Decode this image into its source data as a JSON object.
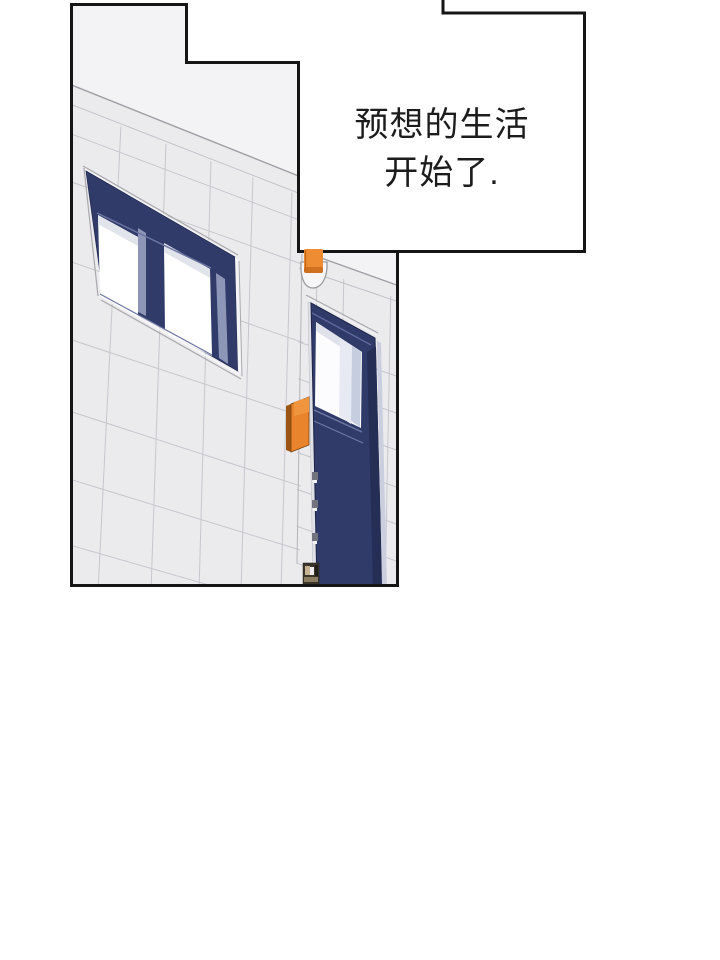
{
  "page": {
    "type": "webtoon-comic-panel",
    "background": "#ffffff"
  },
  "caption": {
    "line1": "预想的生活",
    "line2": "开始了.",
    "text_color": "#1c1c1c",
    "box_fill": "#ffffff",
    "border_color": "#151515"
  },
  "palette": {
    "panel_border": "#151515",
    "sky_light": "#f3f3f6",
    "wall": "#ebebee",
    "tile_line": "#c6c7cd",
    "structure_line": "#9d9ea3",
    "navy": "#303b6a",
    "navy_dark": "#252e55",
    "navy_bevel": "#5d679a",
    "navy_band": "#8e96b8",
    "glass_white": "#ffffff",
    "glass_shadow": "#e2e4ec",
    "orange_sign": "#e9832c",
    "orange_sign_dark": "#9c5513",
    "orange_lamp": "#ee8c34",
    "jamb_light": "#e0e0e7",
    "doorstop_brown": "#3a342b",
    "doorstop_tan": "#c4b291"
  },
  "scene_elements": {
    "panel": "building-exterior-drawing",
    "window": "navy-double-window",
    "door": "navy-door-with-window",
    "sign": "orange-wall-sign",
    "lamp": "orange-corner-lamp",
    "doorstop": "brown-floor-box"
  }
}
